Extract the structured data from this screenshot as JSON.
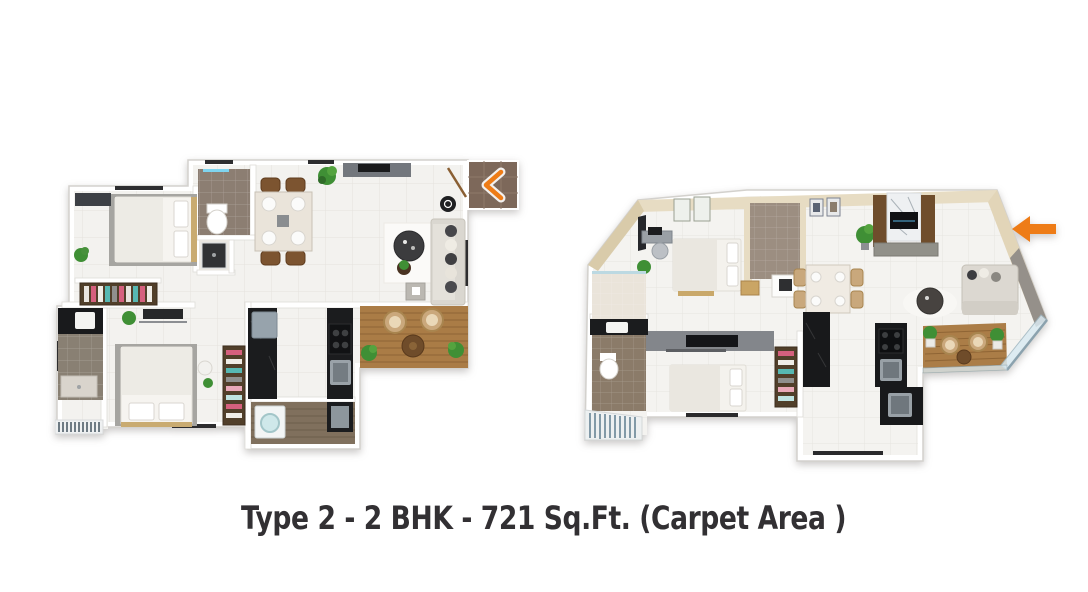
{
  "caption": {
    "text": "Type 2 - 2 BHK - 721 Sq.Ft. (Carpet Area )"
  },
  "icons": {
    "left_plan_entry": "chevron-left-icon",
    "right_plan_entry": "arrow-left-icon"
  },
  "colors": {
    "accent_orange": "#EE7C17",
    "caption_text": "#323033",
    "background": "#FFFFFF"
  }
}
